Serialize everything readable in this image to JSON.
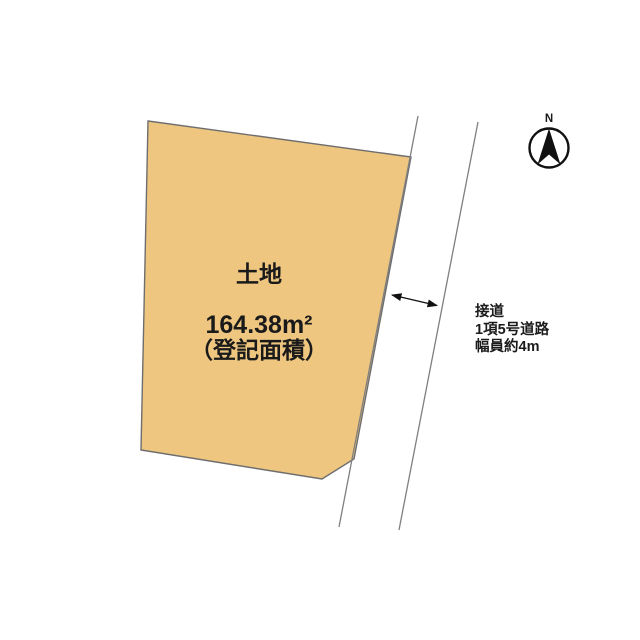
{
  "diagram": {
    "background_color": "#ffffff",
    "parcel": {
      "label": "土地",
      "area_value": "164.38m²",
      "area_note": "（登記面積）",
      "fill_color": "#eec680",
      "border_color": "#6e6e6e"
    },
    "road": {
      "line_color": "#7f7f7f",
      "annotation_lines": [
        "接道",
        "1項5号道路",
        "幅員約4m"
      ]
    },
    "dimension_arrow": {
      "color": "#111111"
    },
    "compass": {
      "north_label": "N",
      "color": "#111111"
    }
  }
}
